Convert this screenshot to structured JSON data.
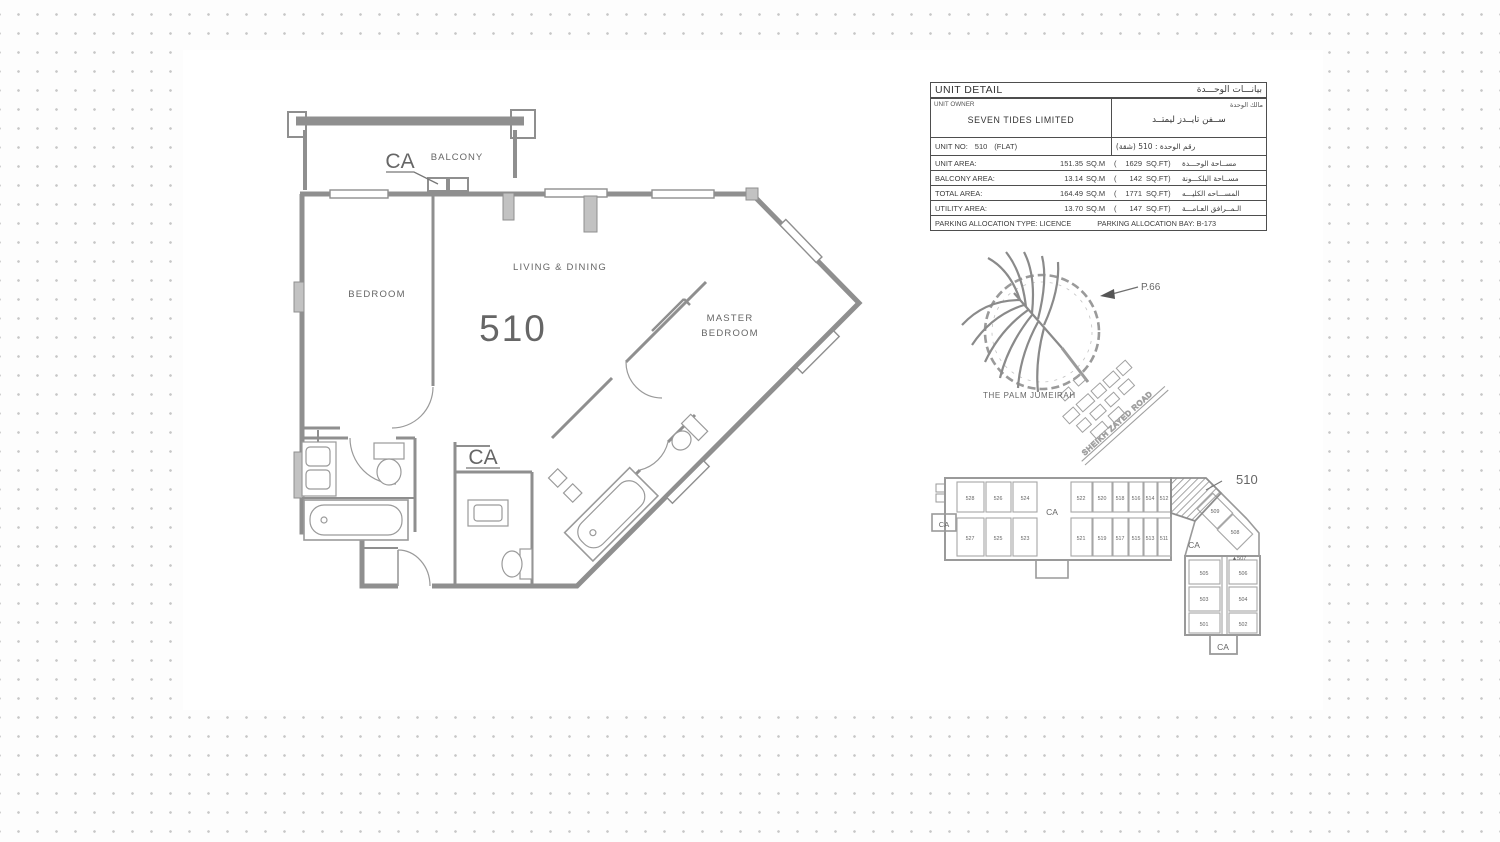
{
  "colors": {
    "line": "#8f8f8f",
    "label_text": "#666666",
    "table_border": "#4e4e4e",
    "dot": "#c7c7c7"
  },
  "floor_plan": {
    "unit_number": "510",
    "balcony": "BALCONY",
    "bedroom": "BEDROOM",
    "living_dining": "LIVING & DINING",
    "master_line1": "MASTER",
    "master_line2": "BEDROOM",
    "ca_balcony": "CA",
    "ca_bath": "CA"
  },
  "unit_table": {
    "title_en": "UNIT DETAIL",
    "title_ar": "بيانـــات الوحـــدة",
    "owner_label_en": "UNIT OWNER",
    "owner_label_ar": "مالك الوحدة",
    "owner_value_en": "SEVEN TIDES LIMITED",
    "owner_value_ar": "ســفن تايــدز ليمتــد",
    "unit_no_label": "UNIT NO:",
    "unit_no_value": "510",
    "unit_no_suffix": "(FLAT)",
    "unit_no_ar": "رقم الوحدة :  510  (شقة)",
    "rows": [
      {
        "label_en": "UNIT AREA:",
        "sqm": "151.35",
        "sqm_unit": "SQ.M",
        "paren": "(",
        "ft": "1629",
        "ft_unit": "SQ.FT)",
        "label_ar": "مســاحة الوحـــدة"
      },
      {
        "label_en": "BALCONY AREA:",
        "sqm": "13.14",
        "sqm_unit": "SQ.M",
        "paren": "(",
        "ft": "142",
        "ft_unit": "SQ.FT)",
        "label_ar": "مســاحة البلكـــونة"
      },
      {
        "label_en": "TOTAL AREA:",
        "sqm": "164.49",
        "sqm_unit": "SQ.M",
        "paren": "(",
        "ft": "1771",
        "ft_unit": "SQ.FT)",
        "label_ar": "المســـاحه الكليـــه"
      },
      {
        "label_en": "UTILITY AREA:",
        "sqm": "13.70",
        "sqm_unit": "SQ.M",
        "paren": "(",
        "ft": "147",
        "ft_unit": "SQ.FT)",
        "label_ar": "الـمــرافق العـامـــة"
      }
    ],
    "parking_type": "PARKING ALLOCATION TYPE:  LICENCE",
    "parking_bay": "PARKING ALLOCATION BAY:  B-173"
  },
  "location_map": {
    "pointer": "P.66",
    "palm": "THE PALM JUMEIRAH",
    "road": "SHEIKH ZAYED ROAD"
  },
  "key_plan": {
    "highlight": "510",
    "top_row": [
      "528",
      "526",
      "524",
      "522",
      "520",
      "518",
      "516",
      "514",
      "512"
    ],
    "bottom_row": [
      "527",
      "525",
      "523",
      "521",
      "519",
      "517",
      "515",
      "513",
      "511"
    ],
    "wing": [
      "509",
      "508"
    ],
    "unit_507": "▲507",
    "block_rows": [
      [
        "505",
        "506"
      ],
      [
        "503",
        "504"
      ],
      [
        "501",
        "502"
      ]
    ],
    "ca_left": "CA",
    "ca_corridor": "CA",
    "ca_wing": "CA",
    "ca_bottom": "CA"
  }
}
